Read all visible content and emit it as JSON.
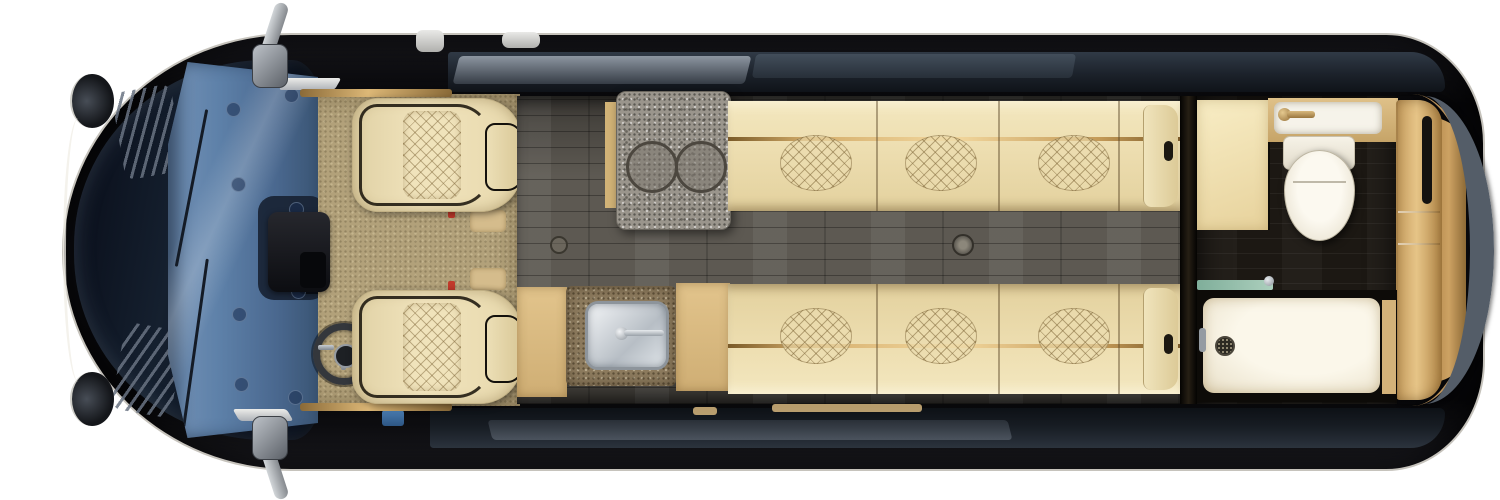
{
  "scene": {
    "description": "Overhead cutaway floor-plan rendering of a luxury Class B camper van interior on a white background",
    "view": "top-down",
    "background_color": "#ffffff",
    "contains_text": false
  },
  "vehicle": {
    "type": "camper-van",
    "exterior_color": "#0a0a0c",
    "areas": [
      {
        "id": "cab",
        "label": "driver-cab",
        "features": [
          "dark hood with vent slats",
          "blue-tinted windshield with wipers",
          "two cream quilted captain chairs",
          "steering wheel",
          "center console",
          "khaki carpet",
          "side mirrors"
        ]
      },
      {
        "id": "galley",
        "label": "galley-kitchen",
        "features": [
          "gray stone counter with two round burners",
          "stainless sink with chrome faucet",
          "tan cabinetry"
        ]
      },
      {
        "id": "lounge",
        "label": "lounge",
        "features": [
          "two facing cream sofa benches with diamond-quilted inserts and gold trim rails",
          "dark gray wood-plank aisle floor",
          "recessed floor rings"
        ]
      },
      {
        "id": "wet-bath",
        "label": "rear-wet-bath",
        "features": [
          "cream privacy panel",
          "white vanity basin with bronze faucet",
          "white toilet",
          "white shower pan with drain",
          "teal glass partition",
          "tan wardrobe cabinet",
          "near-black wood floor"
        ]
      },
      {
        "id": "rear",
        "label": "rear-doors",
        "features": [
          "tan door panels",
          "curved gray rear-window band",
          "bronze trim arc"
        ]
      }
    ],
    "counts": {
      "captain_chairs": 2,
      "cooktop_burners": 2,
      "sofa_benches": 2,
      "quilted_inserts_per_bench": 3,
      "sinks": 2,
      "toilets": 1,
      "showers": 1,
      "side_mirrors": 2
    }
  },
  "palette": {
    "body_black": "#0a0a0c",
    "hood_navy": "#121b2c",
    "windshield_blue": "#5d80a8",
    "carpet_khaki": "#b2a17a",
    "leather_cream": "#eedfb2",
    "gold_trim": "#d4ad6b",
    "counter_granite_gray": "#9a958c",
    "counter_granite_brown": "#8d7b5e",
    "cabinet_tan": "#d9ba80",
    "aisle_wood_gray": "#5d5952",
    "bath_wood_dark": "#1c1813",
    "fixture_white": "#f6f3ea",
    "steel_chrome": "#c8cdd2",
    "glass_teal": "#8fb7a5",
    "rear_band_gray": "#545d68"
  }
}
